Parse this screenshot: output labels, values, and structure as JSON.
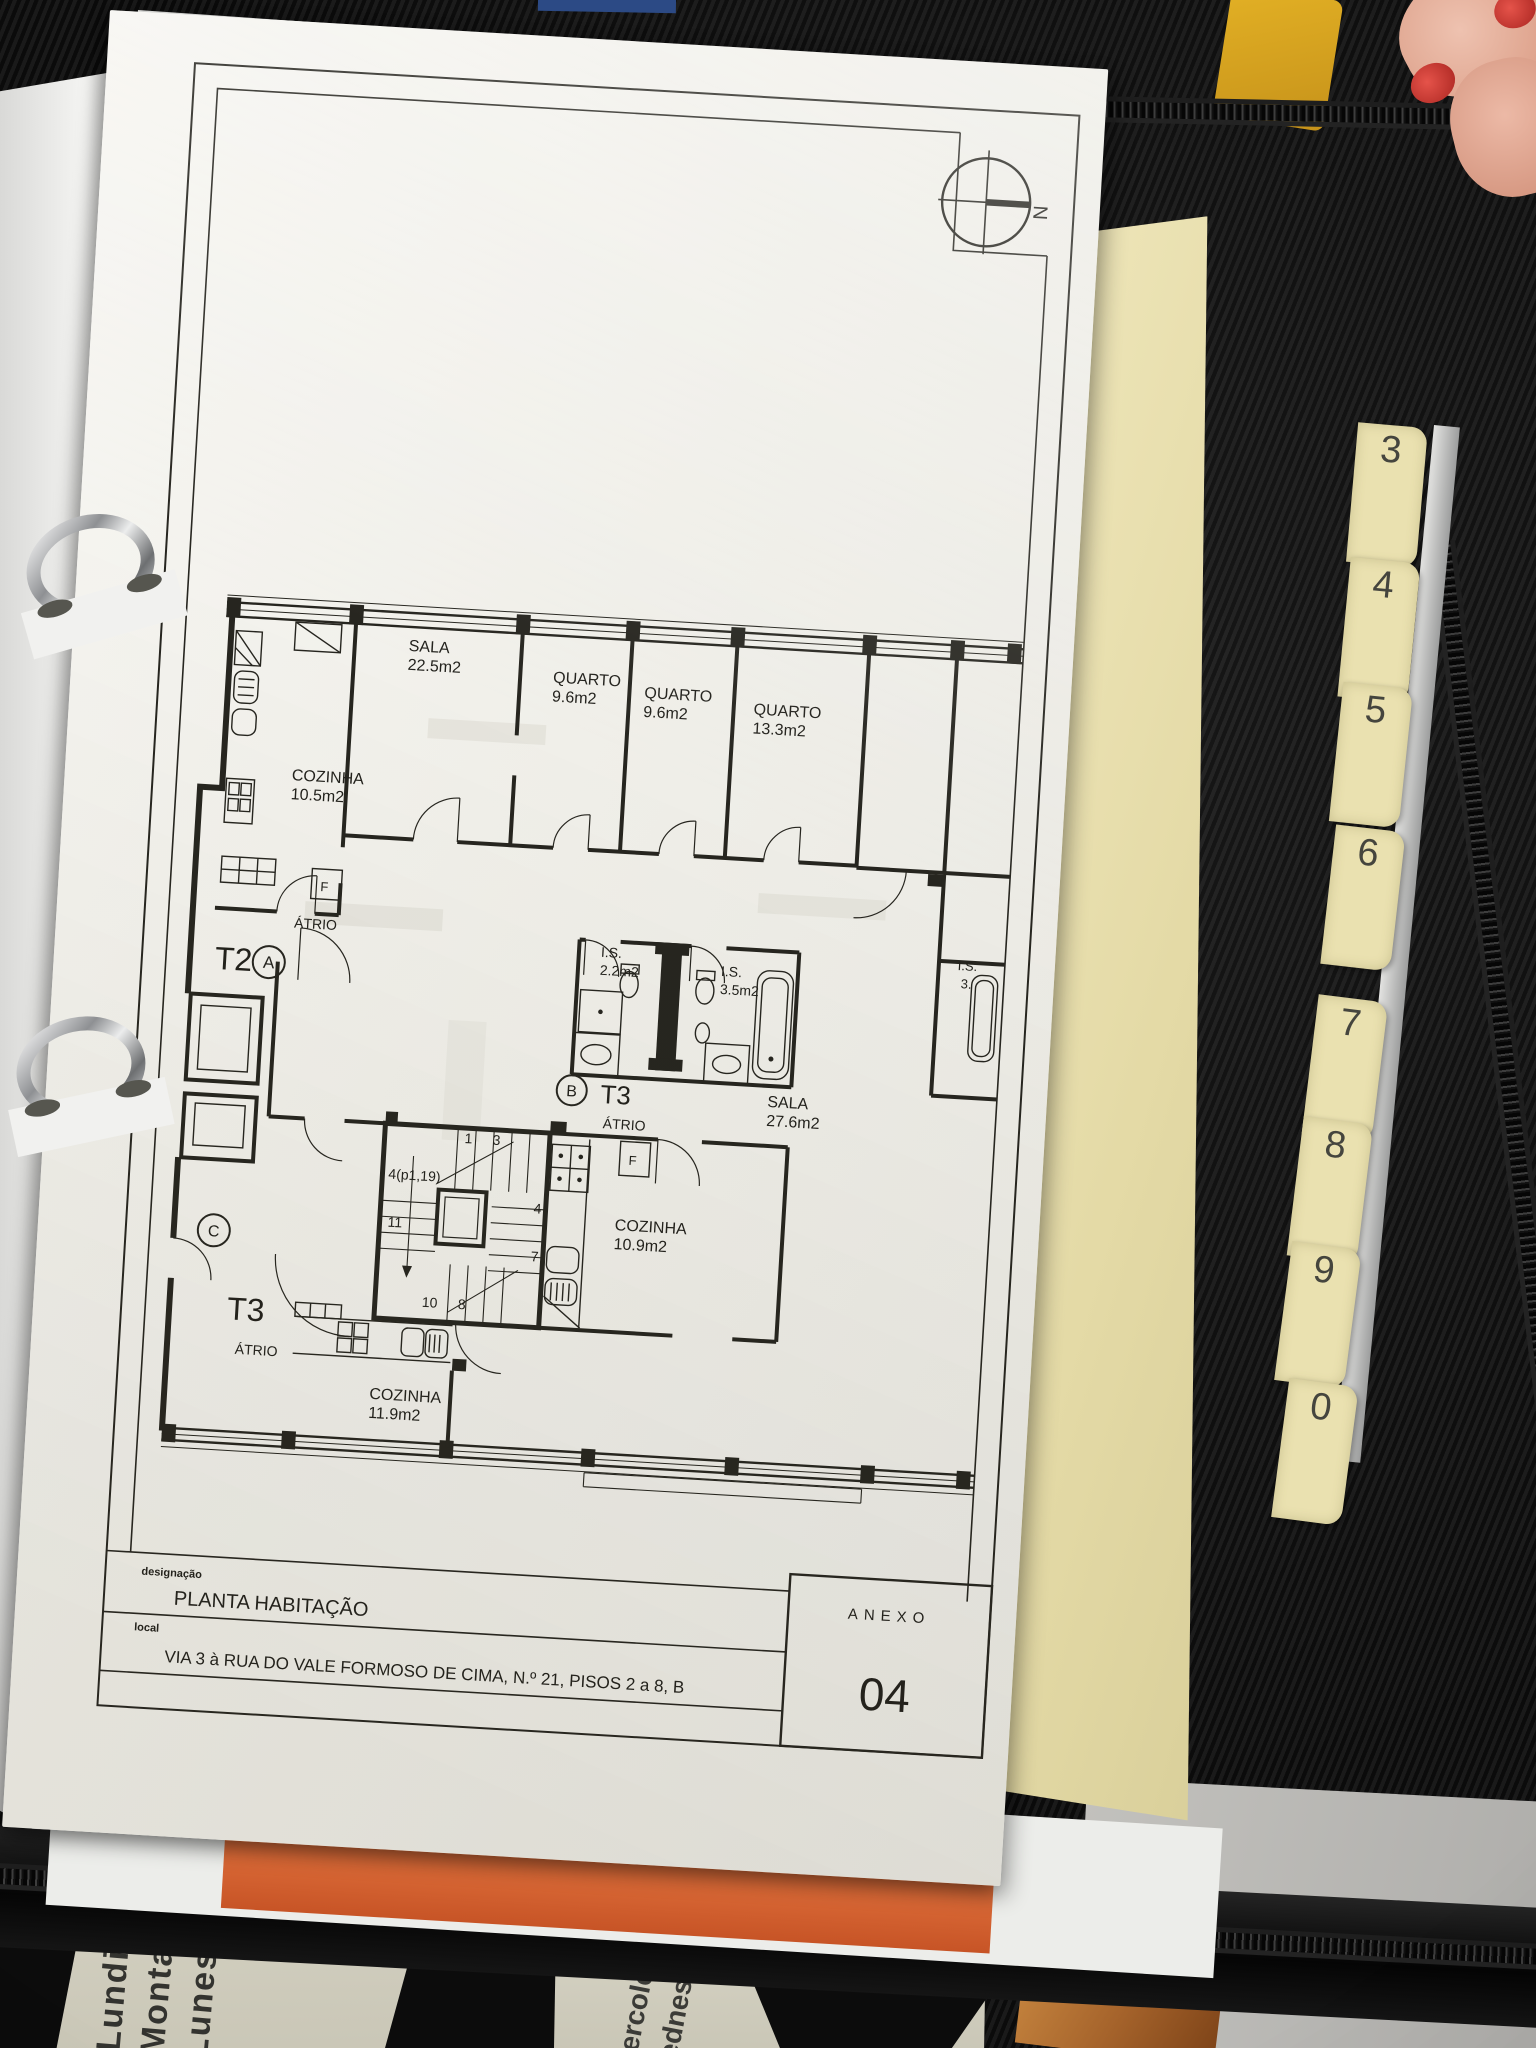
{
  "scene": {
    "compass_north": "N",
    "binder_tabs": [
      "3",
      "4",
      "5",
      "6",
      "7",
      "8",
      "9",
      "0"
    ],
    "calendar_left_lines": [
      "Lundi",
      "Montag",
      "Lunes"
    ],
    "calendar_mid_lines": [
      "ercoled",
      "ednes"
    ],
    "colors": {
      "paper": "#f0efe9",
      "divider_cream": "#eae1b0",
      "binder_black": "#121212",
      "sheet_orange": "#d4622f",
      "nail_red": "#c53431"
    }
  },
  "plan": {
    "units": {
      "a": {
        "type": "T2",
        "letter": "A",
        "atrio": "ÁTRIO"
      },
      "b": {
        "type": "T3",
        "letter": "B",
        "atrio": "ÁTRIO"
      },
      "c": {
        "type": "T3",
        "letter": "C",
        "atrio": "ÁTRIO"
      }
    },
    "rooms": {
      "sala_a": {
        "name": "SALA",
        "area": "22.5m2"
      },
      "quarto_1": {
        "name": "QUARTO",
        "area": "9.6m2"
      },
      "quarto_2": {
        "name": "QUARTO",
        "area": "9.6m2"
      },
      "quarto_3": {
        "name": "QUARTO",
        "area": "13.3m2"
      },
      "cozinha_a": {
        "name": "COZINHA",
        "area": "10.5m2"
      },
      "is_1": {
        "name": "I.S.",
        "area": "2.2m2"
      },
      "is_2": {
        "name": "I.S.",
        "area": "3.5m2"
      },
      "is_edge": {
        "name": "I.S.",
        "area": "3."
      },
      "sala_b": {
        "name": "SALA",
        "area": "27.6m2"
      },
      "cozinha_b": {
        "name": "COZINHA",
        "area": "10.9m2"
      },
      "cozinha_c": {
        "name": "COZINHA",
        "area": "11.9m2"
      }
    },
    "fridge_label": "F",
    "stair_numbers": [
      "1",
      "3",
      "4(p1,19)",
      "4",
      "11",
      "7",
      "10",
      "8"
    ]
  },
  "title_block": {
    "designacao_label": "designação",
    "designacao_value": "PLANTA HABITAÇÃO",
    "local_label": "local",
    "local_value": "VIA 3 à RUA DO VALE FORMOSO DE CIMA, N.º 21, PISOS 2 a 8, B",
    "anexo_label": "ANEXO",
    "anexo_number": "04"
  }
}
